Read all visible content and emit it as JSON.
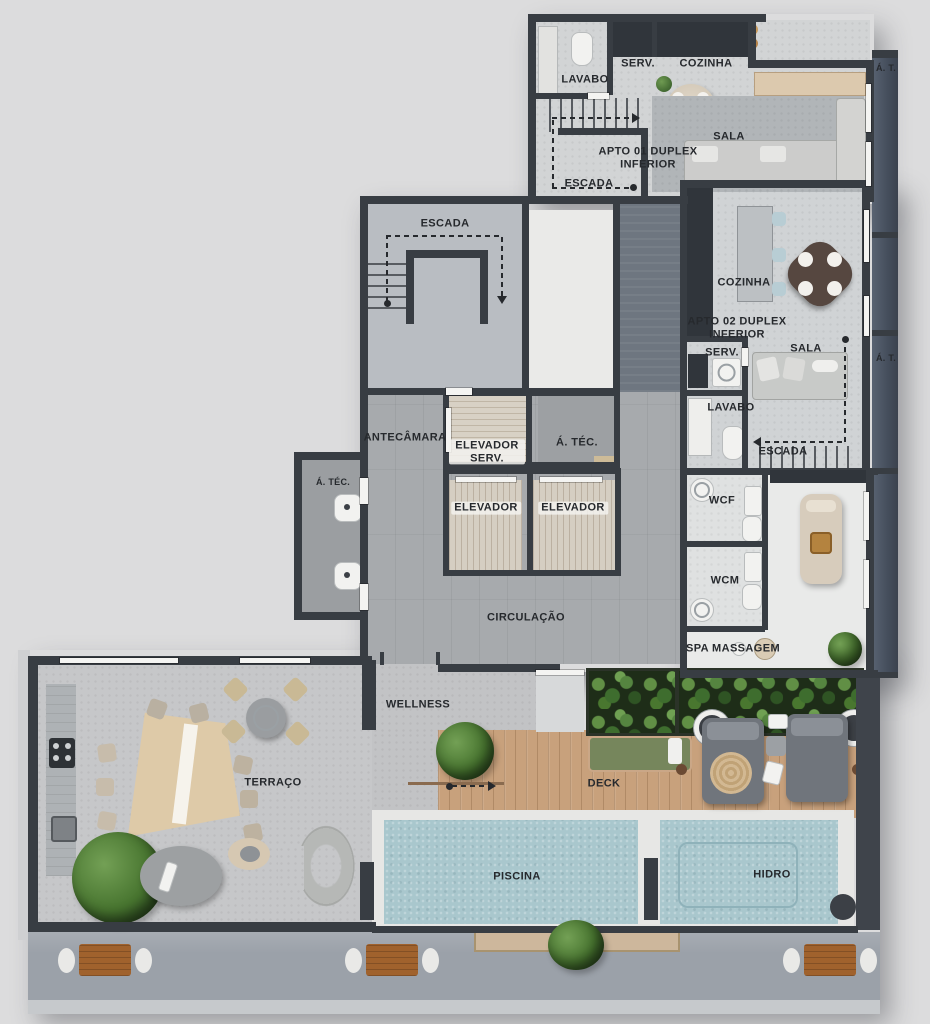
{
  "title": "Residential floor plan — duplex inferior level with wellness deck",
  "colors": {
    "background": "#dcdcdd",
    "wall": "#383d43",
    "concrete_floor": "#c5c6c8",
    "deck_wood": "#c8a17c",
    "pool_water": "#a9c7cd",
    "plant_green": "#3f6b33",
    "label_text": "#26292d",
    "tech_strip": "#4a5462"
  },
  "labels": {
    "apto01_lavabo": "LAVABO",
    "apto01_serv": "SERV.",
    "apto01_cozinha": "COZINHA",
    "apto01_sala": "SALA",
    "apto01_unit": "APTO 01 DUPLEX INFERIOR",
    "apto01_escada": "ESCADA",
    "at_top": "Á. T.",
    "core_escada": "ESCADA",
    "apto02_cozinha": "COZINHA",
    "apto02_unit": "APTO 02 DUPLEX INFERIOR",
    "apto02_serv": "SERV.",
    "apto02_sala": "SALA",
    "at_right": "Á. T.",
    "apto02_lavabo": "LAVABO",
    "apto02_escada": "ESCADA",
    "antecamara": "ANTECÂMARA",
    "elevador_serv": "ELEVADOR SERV.",
    "atec_core": "Á. TÉC.",
    "atec_left": "Á. TÉC.",
    "elevador_1": "ELEVADOR",
    "elevador_2": "ELEVADOR",
    "circulacao": "CIRCULAÇÃO",
    "wcf": "WCF",
    "wcm": "WCM",
    "spa": "SPA MASSAGEM",
    "wellness": "WELLNESS",
    "terraco": "TERRAÇO",
    "deck": "DECK",
    "piscina": "PISCINA",
    "hidro": "HIDRO"
  }
}
